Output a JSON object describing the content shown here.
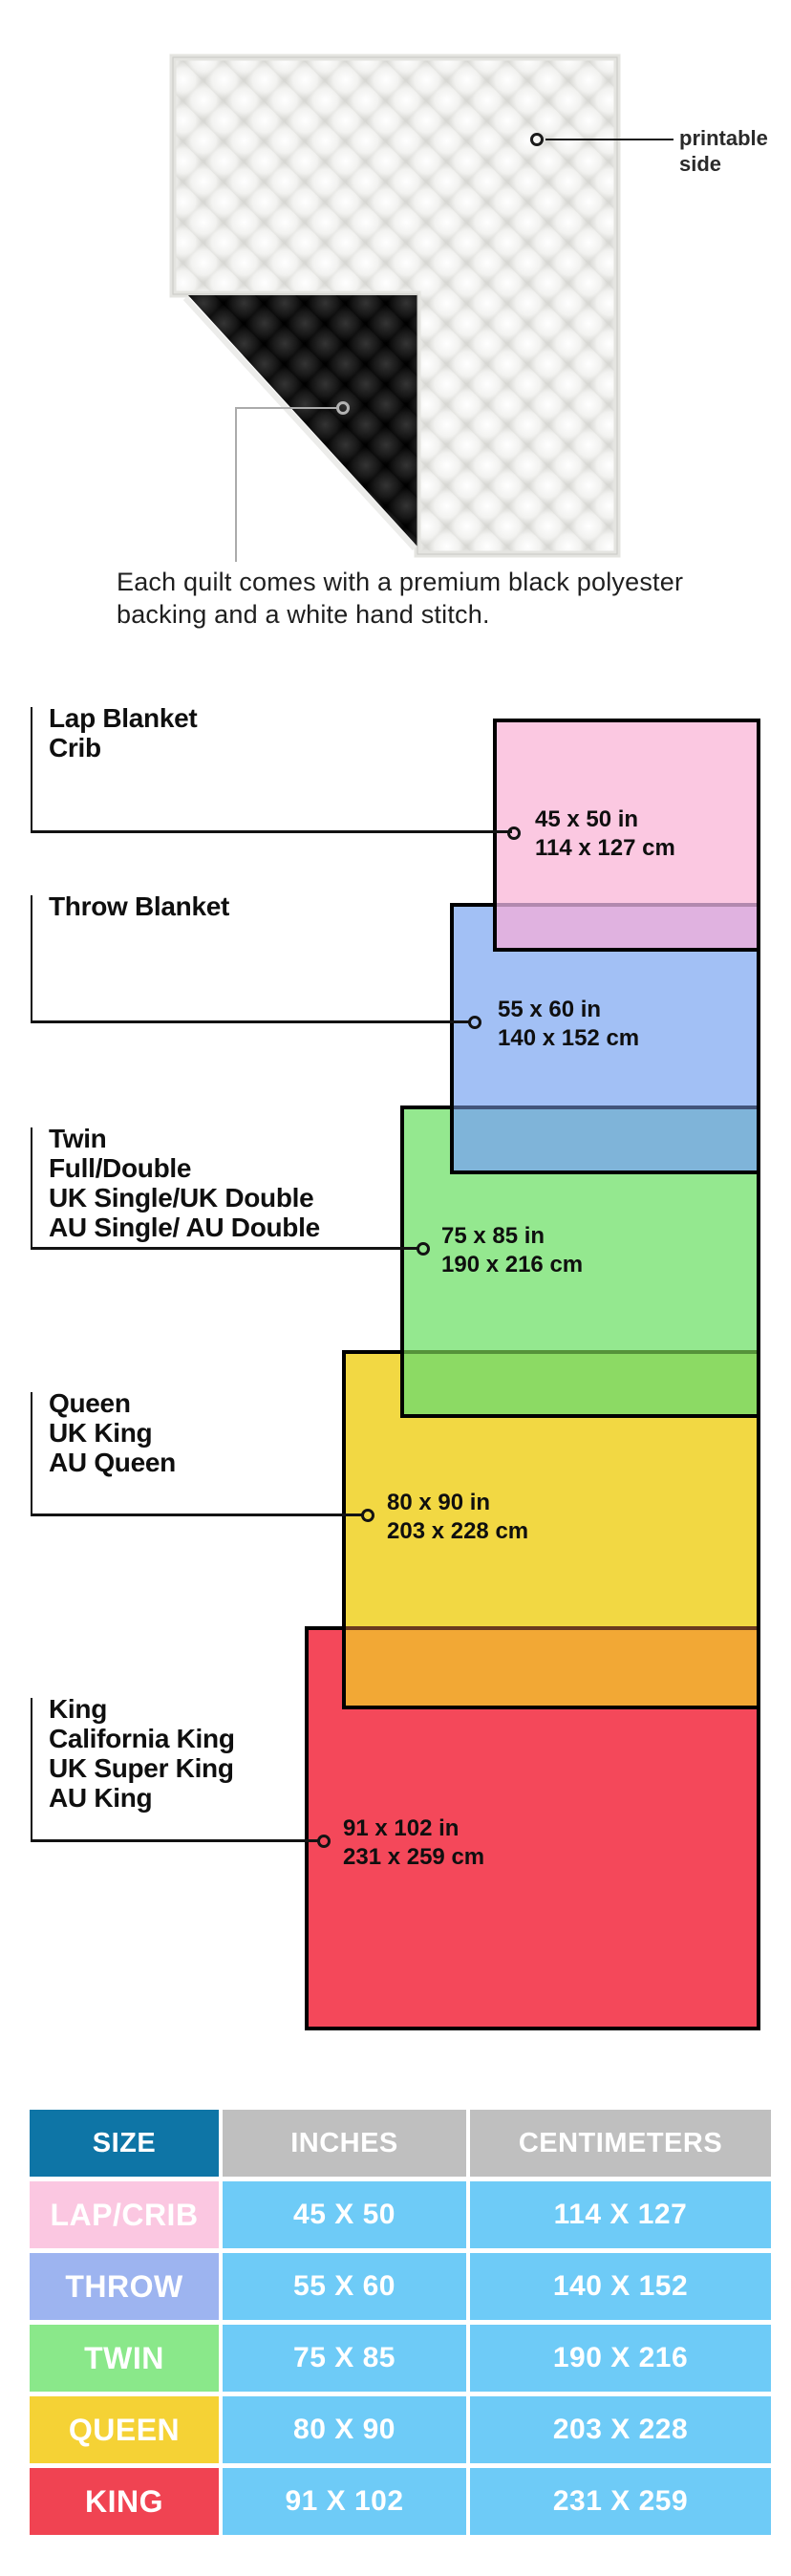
{
  "figure": {
    "printable_label": "printable side",
    "caption": {
      "line1": "Each quilt comes with a premium black polyester",
      "line2": "backing and a white hand stitch."
    },
    "quilt_colors": {
      "front": "#f3f3f1",
      "backing": "#141414",
      "binding": "#e4e4e0"
    }
  },
  "diagram": {
    "groups": [
      {
        "id": "lap",
        "names": [
          "Lap Blanket",
          "Crib"
        ],
        "dims": [
          "45 x 50 in",
          "114 x 127 cm"
        ],
        "fill": "#fbc8e1",
        "overlap_fill": "#e0b2e0",
        "overlap_line": "#b289ae"
      },
      {
        "id": "throw",
        "names": [
          "Throw Blanket"
        ],
        "dims": [
          "55 x 60 in",
          "140 x 152 cm"
        ],
        "fill": "#a2c0f5",
        "overlap_fill": "#7fb4d9",
        "overlap_line": "#42547a"
      },
      {
        "id": "twin",
        "names": [
          "Twin",
          "Full/Double",
          "UK Single/UK Double",
          "AU Single/ AU Double"
        ],
        "dims": [
          "75 x 85 in",
          "190 x 216 cm"
        ],
        "fill": "#94e88f",
        "overlap_fill": "#8cda64",
        "overlap_line": "#55923a"
      },
      {
        "id": "queen",
        "names": [
          "Queen",
          "UK King",
          "AU Queen"
        ],
        "dims": [
          "80 x 90 in",
          "203 x 228 cm"
        ],
        "fill": "#f2d843",
        "overlap_fill": "#f2a835",
        "overlap_line": "#6b3a1e"
      },
      {
        "id": "king",
        "names": [
          "King",
          "California King",
          "UK Super King",
          "AU King"
        ],
        "dims": [
          "91 x 102 in",
          "231 x 259 cm"
        ],
        "fill": "#f4485a",
        "overlap_fill": null,
        "overlap_line": null
      }
    ],
    "border_color": "#000000"
  },
  "table": {
    "headers": [
      "SIZE",
      "INCHES",
      "CENTIMETERS"
    ],
    "header_colors": {
      "size_bg": "#0e75a6",
      "metric_bg": "#bfbfbf"
    },
    "value_cell_bg": "#6ecbf7",
    "rows": [
      {
        "label": "LAP/CRIB",
        "inches": "45 X 50",
        "cm": "114 X 127",
        "label_bg": "#fbc7e1"
      },
      {
        "label": "THROW",
        "inches": "55 X 60",
        "cm": "140 X 152",
        "label_bg": "#9db4f0"
      },
      {
        "label": "TWIN",
        "inches": "75 X 85",
        "cm": "190 X 216",
        "label_bg": "#8ae88a"
      },
      {
        "label": "QUEEN",
        "inches": "80 X 90",
        "cm": "203 X 228",
        "label_bg": "#f5d235"
      },
      {
        "label": "KING",
        "inches": "91 X 102",
        "cm": "231 X 259",
        "label_bg": "#f04352"
      }
    ]
  }
}
